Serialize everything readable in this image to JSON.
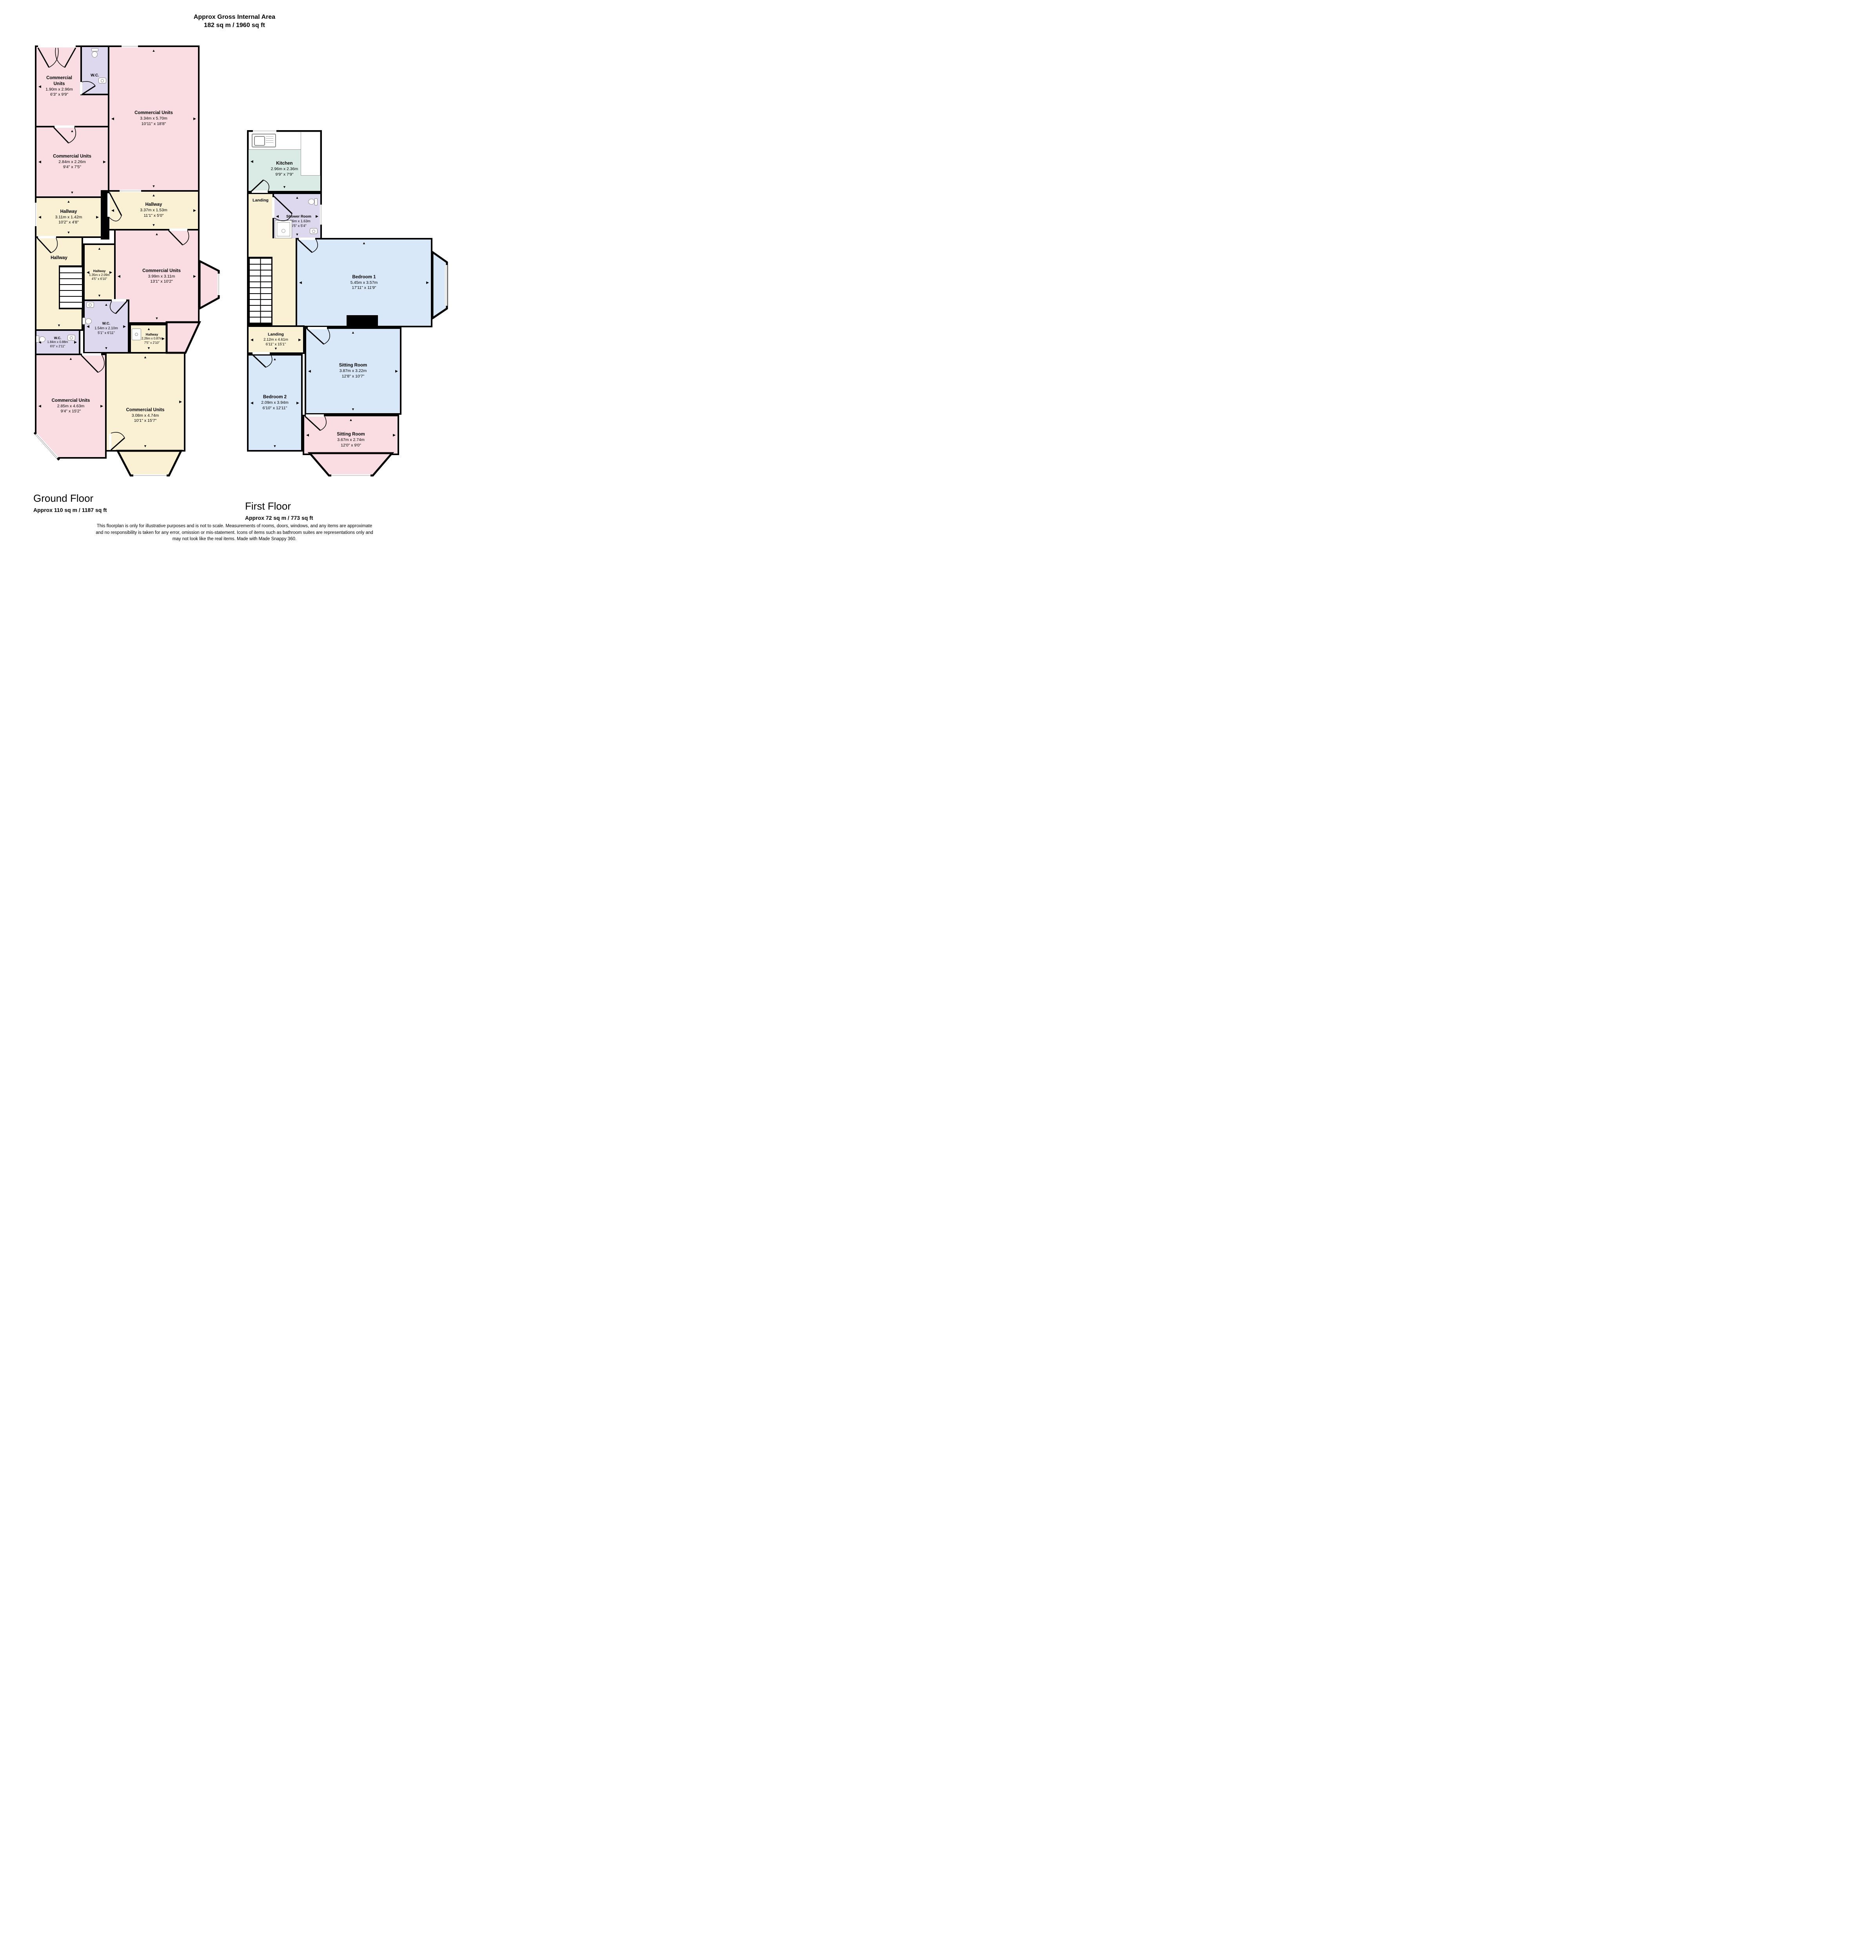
{
  "page": {
    "title_line1": "Approx Gross Internal Area",
    "title_line2": "182 sq m / 1960 sq ft",
    "disclaimer_line1": "This floorplan is only for illustrative purposes and is not to scale. Measurements of rooms, doors, windows, and any items are approximate",
    "disclaimer_line2": "and no responsibility is taken for any error, omission or mis-statement. Icons of items such as bathroom suites are representations only and",
    "disclaimer_line3": "may not look like the real items. Made with Made Snappy 360."
  },
  "colors": {
    "commercial": "#F9DDE3",
    "hallway": "#FAF1D5",
    "wc": "#DED8EE",
    "kitchen": "#D9EBE4",
    "bedroom_sitting_blue": "#D8E8F8",
    "wall": "#000000"
  },
  "ground_floor": {
    "label": "Ground Floor",
    "area": "Approx 110 sq m / 1187 sq ft",
    "rooms": {
      "commercial_top_left": {
        "name": "Commercial Units",
        "m": "1.90m x 2.96m",
        "ft": "6'3\" x 9'9\""
      },
      "wc_top": {
        "name": "W.C."
      },
      "commercial_large": {
        "name": "Commercial Units",
        "m": "3.34m x 5.70m",
        "ft": "10'11\" x 18'8\""
      },
      "commercial_mid_left": {
        "name": "Commercial Units",
        "m": "2.84m x 2.26m",
        "ft": "9'4\" x 7'5\""
      },
      "hallway_left": {
        "name": "Hallway",
        "m": "3.11m x 1.42m",
        "ft": "10'2\" x 4'8\""
      },
      "hallway_center": {
        "name": "Hallway",
        "m": "3.37m x 1.53m",
        "ft": "11'1\" x 5'0\""
      },
      "hallway_stairs": {
        "name": "Hallway"
      },
      "hallway_small": {
        "name": "Hallway",
        "m": "1.35m x 2.09m",
        "ft": "4'5\" x 6'10\""
      },
      "commercial_center": {
        "name": "Commercial Units",
        "m": "3.99m x 3.11m",
        "ft": "13'1\" x 10'2\""
      },
      "wc_center": {
        "name": "W.C.",
        "m": "1.54m x 2.10m",
        "ft": "5'1\" x 6'11\""
      },
      "wc_left": {
        "name": "W.C.",
        "m": "1.84m x 0.88m",
        "ft": "6'0\" x 2'11\""
      },
      "hallway_tiny": {
        "name": "Hallway",
        "m": "2.26m x 0.87m",
        "ft": "7'5\" x 2'10\""
      },
      "commercial_bottom_left": {
        "name": "Commercial Units",
        "m": "2.85m x 4.63m",
        "ft": "9'4\" x 15'2\""
      },
      "commercial_bottom_right": {
        "name": "Commercial Units",
        "m": "3.08m x 4.74m",
        "ft": "10'1\" x 15'7\""
      }
    }
  },
  "first_floor": {
    "label": "First Floor",
    "area": "Approx 72 sq m / 773 sq ft",
    "rooms": {
      "kitchen": {
        "name": "Kitchen",
        "m": "2.96m x 2.36m",
        "ft": "9'9\" x 7'9\""
      },
      "landing_upper": {
        "name": "Landing"
      },
      "shower_room": {
        "name": "Shower Room",
        "m": "1.96m x 1.63m",
        "ft": "6'5\" x 5'4\""
      },
      "bedroom_1": {
        "name": "Bedroom 1",
        "m": "5.45m x 3.57m",
        "ft": "17'11\" x 11'9\""
      },
      "landing_lower": {
        "name": "Landing",
        "m": "2.12m x 4.61m",
        "ft": "6'11\" x 15'1\""
      },
      "sitting_room_1": {
        "name": "Sitting Room",
        "m": "3.87m x 3.22m",
        "ft": "12'8\" x 10'7\""
      },
      "bedroom_2": {
        "name": "Bedroom 2",
        "m": "2.09m x 3.94m",
        "ft": "6'10\" x 12'11\""
      },
      "sitting_room_2": {
        "name": "Sitting Room",
        "m": "3.67m x 2.74m",
        "ft": "12'0\" x 9'0\""
      }
    }
  }
}
